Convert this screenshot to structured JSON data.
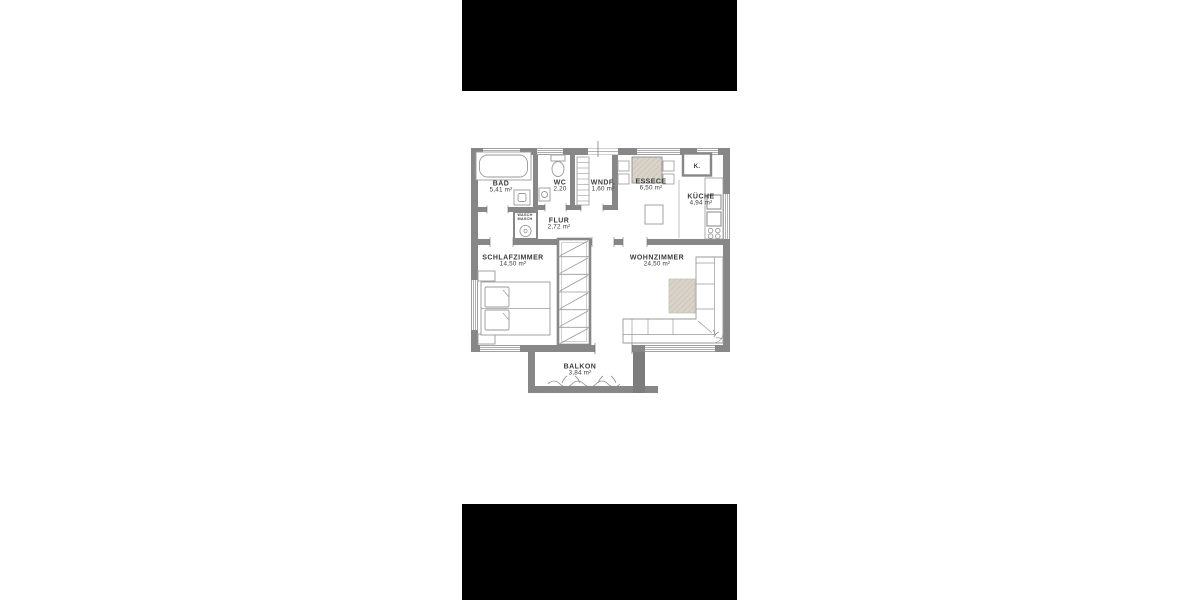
{
  "canvas": {
    "background": "#ffffff"
  },
  "photo": {
    "letterbox_color": "#000000",
    "plan_background": "#ffffff"
  },
  "floorplan": {
    "colors": {
      "wall": "#878787",
      "wall_dark": "#6f6f6f",
      "furniture_line": "#9a9a9a",
      "hatch_beige": "#d9d3c9",
      "hatch_beige_stripe": "#c6bfb2",
      "text": "#3b3b3b"
    },
    "rooms": {
      "bad": {
        "name": "BAD",
        "area": "5,41 m²"
      },
      "wc": {
        "name": "WC",
        "area": "2,20"
      },
      "wndf": {
        "name": "WNDF.",
        "area": "1,60 m²"
      },
      "essece": {
        "name": "ESSECE",
        "area": "6,50 m²"
      },
      "k": {
        "name": "K."
      },
      "kueche": {
        "name": "KÜCHE",
        "area": "4,94 m²"
      },
      "wasch": {
        "line1": "WASCH",
        "line2": "MASCH"
      },
      "flur": {
        "name": "FLUR",
        "area": "2,72 m²"
      },
      "schlafzimmer": {
        "name": "SCHLAFZIMMER",
        "area": "14,50 m²"
      },
      "wohnzimmer": {
        "name": "WOHNZIMMER",
        "area": "24,50 m²"
      },
      "balkon": {
        "name": "BALKON",
        "area": "3,84 m²"
      }
    }
  }
}
